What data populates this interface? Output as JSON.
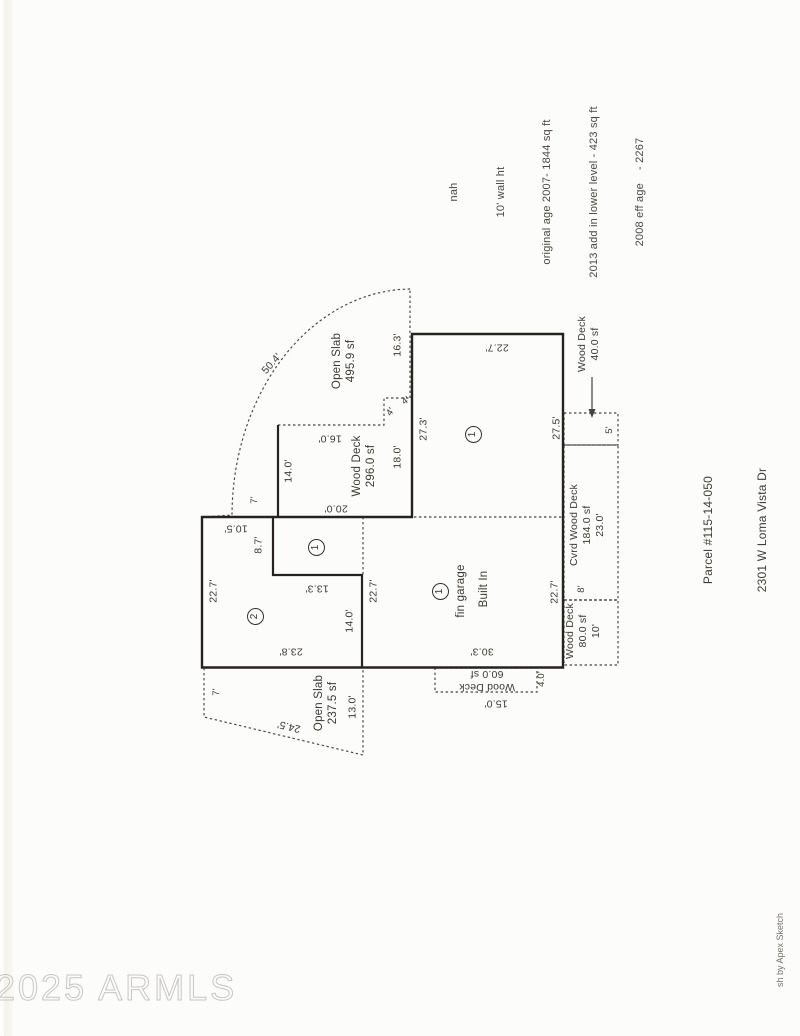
{
  "colors": {
    "ink": "#26231f",
    "dash_ink": "#45423c",
    "label_ink": "#3c3831",
    "watermark_outline": "#c9c6c0",
    "paper": "#fcfcfa"
  },
  "watermark": {
    "text": "2025 ARMLS"
  },
  "credit": {
    "text": "sh by Apex Sketch"
  },
  "header_notes": {
    "lines": [
      "nah",
      "10' wall ht",
      "original age 2007- 1844 sq ft",
      "2013 add in lower level - 423 sq ft",
      "2008 eff age    - 2267"
    ]
  },
  "property_info": {
    "lines": [
      "Parcel #115-14-050",
      "2301 W Loma Vista Dr",
      "Vista Del Cerro Lot 50"
    ]
  },
  "plan": {
    "area_markers": [
      {
        "name": "area-marker-1-main",
        "label": "1",
        "x": 473,
        "y": 434
      },
      {
        "name": "area-marker-1-small",
        "label": "1",
        "x": 316,
        "y": 547
      },
      {
        "name": "area-marker-1-garage",
        "label": "1",
        "x": 440,
        "y": 591
      },
      {
        "name": "area-marker-2",
        "label": "2",
        "x": 255,
        "y": 616
      }
    ],
    "labels": [
      {
        "name": "dim-arc-length",
        "text": "50.4'",
        "x": 272,
        "y": 364,
        "rot": -48,
        "size": 10.5
      },
      {
        "name": "open-slab-upper-label",
        "text": "Open Slab\n495.9 sf",
        "x": 344,
        "y": 361,
        "rot": -90,
        "size": 11.5
      },
      {
        "name": "dim-open-slab-right",
        "text": "16.3'",
        "x": 398,
        "y": 345,
        "rot": -90,
        "size": 10.5
      },
      {
        "name": "dim-area1-top",
        "text": "22.7'",
        "x": 497,
        "y": 347,
        "rot": 180,
        "size": 10.5
      },
      {
        "name": "dim-area1-left",
        "text": "27.3'",
        "x": 424,
        "y": 429,
        "rot": -90,
        "size": 10.5
      },
      {
        "name": "dim-area1-right",
        "text": "27.5'",
        "x": 557,
        "y": 428,
        "rot": -90,
        "size": 10.5
      },
      {
        "name": "wood-deck-40-label",
        "text": "Wood Deck\n40.0 sf",
        "x": 589,
        "y": 344,
        "rot": -90,
        "size": 10.5
      },
      {
        "name": "dim-wood-deck-40",
        "text": "5'",
        "x": 610,
        "y": 430,
        "rot": -90,
        "size": 9.5
      },
      {
        "name": "wood-deck-296-label",
        "text": "Wood Deck\n296.0 sf",
        "x": 364,
        "y": 466,
        "rot": -90,
        "size": 11.5
      },
      {
        "name": "dim-wood-deck-top",
        "text": "16.0'",
        "x": 330,
        "y": 438,
        "rot": 180,
        "size": 10.5
      },
      {
        "name": "dim-wood-deck-left",
        "text": "14.0'",
        "x": 289,
        "y": 471,
        "rot": -90,
        "size": 10.5
      },
      {
        "name": "dim-wood-deck-right",
        "text": "18.0'",
        "x": 398,
        "y": 457,
        "rot": -90,
        "size": 10.5
      },
      {
        "name": "dim-step-a",
        "text": "4'",
        "x": 391,
        "y": 412,
        "rot": -55,
        "size": 9.5
      },
      {
        "name": "dim-step-b",
        "text": "4'",
        "x": 406,
        "y": 401,
        "rot": -35,
        "size": 9.5
      },
      {
        "name": "dim-wood-deck-bottom",
        "text": "20.0'",
        "x": 336,
        "y": 508,
        "rot": 180,
        "size": 10.5
      },
      {
        "name": "dim-arc-connector",
        "text": "7'",
        "x": 255,
        "y": 500,
        "rot": -90,
        "size": 9.5
      },
      {
        "name": "dim-area2-top",
        "text": "10.5'",
        "x": 236,
        "y": 528,
        "rot": 180,
        "size": 10.5
      },
      {
        "name": "dim-area2-notch-v",
        "text": "8.7'",
        "x": 259,
        "y": 545,
        "rot": -90,
        "size": 10.5
      },
      {
        "name": "dim-area2-notch-h",
        "text": "13.3'",
        "x": 317,
        "y": 588,
        "rot": 180,
        "size": 10.5
      },
      {
        "name": "dim-area2-right",
        "text": "14.0'",
        "x": 350,
        "y": 621,
        "rot": -90,
        "size": 10.5
      },
      {
        "name": "dim-area2-left",
        "text": "22.7'",
        "x": 214,
        "y": 591,
        "rot": -90,
        "size": 10.5
      },
      {
        "name": "dim-garage-left",
        "text": "22.7'",
        "x": 374,
        "y": 591,
        "rot": -90,
        "size": 10.5
      },
      {
        "name": "dim-area2-bottom",
        "text": "23.8'",
        "x": 291,
        "y": 651,
        "rot": 180,
        "size": 10.5
      },
      {
        "name": "garage-label",
        "text": "fin garage",
        "x": 461,
        "y": 591,
        "rot": -90,
        "size": 11.5
      },
      {
        "name": "garage-builtin-label",
        "text": "Built In",
        "x": 484,
        "y": 589,
        "rot": -90,
        "size": 11.5
      },
      {
        "name": "dim-garage-right",
        "text": "22.7'",
        "x": 555,
        "y": 592,
        "rot": -90,
        "size": 10.5
      },
      {
        "name": "dim-garage-bottom",
        "text": "30.3'",
        "x": 482,
        "y": 651,
        "rot": 180,
        "size": 10.5
      },
      {
        "name": "cvrd-wood-deck-label",
        "text": "Cvrd Wood Deck\n184.0 sf\n23.0'",
        "x": 587,
        "y": 525,
        "rot": -90,
        "size": 10.5
      },
      {
        "name": "dim-cvrd-deck-width",
        "text": "8'",
        "x": 582,
        "y": 589,
        "rot": -90,
        "size": 9.5
      },
      {
        "name": "wood-deck-80-label",
        "text": "Wood Deck\n80.0 sf\n10'",
        "x": 583,
        "y": 631,
        "rot": -90,
        "size": 10.5
      },
      {
        "name": "wood-deck-60-label",
        "text": "Wood Deck\n60.0 sf",
        "x": 487,
        "y": 680,
        "rot": 180,
        "size": 10.5
      },
      {
        "name": "dim-wood-deck-60-right",
        "text": "4.0'",
        "x": 542,
        "y": 679,
        "rot": -90,
        "size": 9.5
      },
      {
        "name": "dim-wood-deck-60-bottom",
        "text": "15.0'",
        "x": 496,
        "y": 703,
        "rot": 180,
        "size": 10.5
      },
      {
        "name": "open-slab-lower-label",
        "text": "Open Slab\n237.5 sf",
        "x": 326,
        "y": 703,
        "rot": -90,
        "size": 11.5
      },
      {
        "name": "dim-open-slab-lower-right",
        "text": "13.0'",
        "x": 353,
        "y": 707,
        "rot": -90,
        "size": 10.5
      },
      {
        "name": "dim-open-slab-lower-diag",
        "text": "24.5'",
        "x": 289,
        "y": 726,
        "rot": 193,
        "size": 10.5
      },
      {
        "name": "dim-open-slab-lower-left",
        "text": "7'",
        "x": 217,
        "y": 692,
        "rot": -90,
        "size": 9.5
      }
    ]
  }
}
